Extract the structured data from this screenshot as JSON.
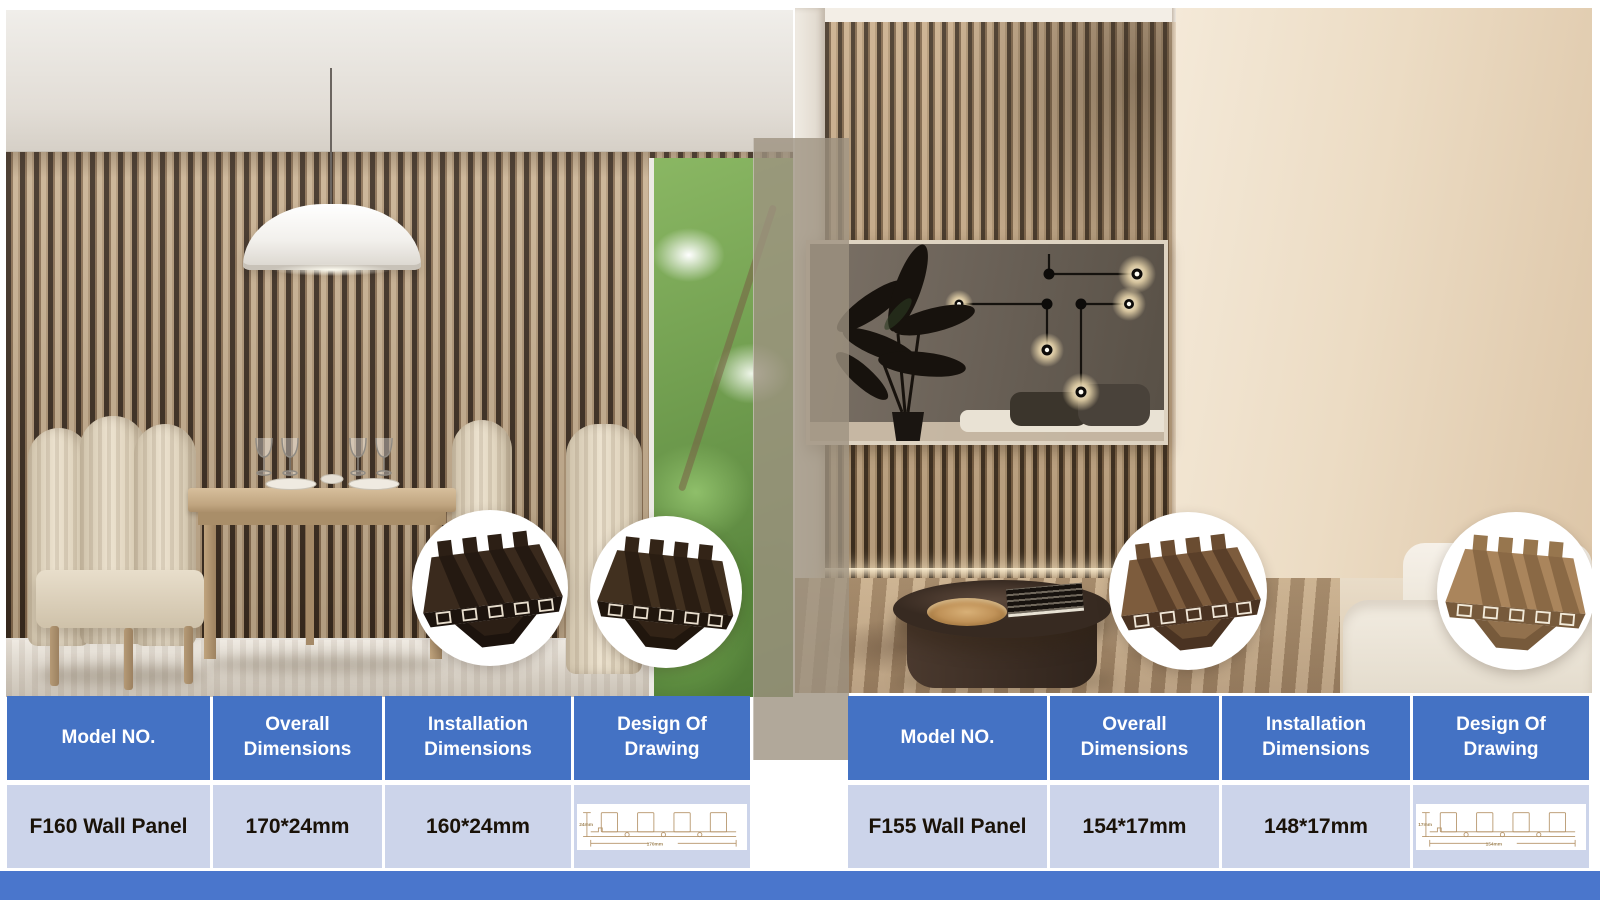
{
  "tables": {
    "headers": [
      "Model NO.",
      "Overall Dimensions",
      "Installation Dimensions",
      "Design Of Drawing"
    ],
    "left": {
      "model": "F160 Wall Panel",
      "overall_dimensions": "170*24mm",
      "installation_dimensions": "160*24mm",
      "drawing_height_label": "24mm",
      "drawing_width_label": "170mm"
    },
    "right": {
      "model": "F155 Wall Panel",
      "overall_dimensions": "154*17mm",
      "installation_dimensions": "148*17mm",
      "drawing_height_label": "17mm",
      "drawing_width_label": "154mm"
    }
  },
  "colors": {
    "header_blue": "#4472c4",
    "row_light_blue": "#ccd4ea",
    "bottom_bar_blue": "#4a76cc",
    "slat_wood": "#c8ab87",
    "slat_gap": "#40301f",
    "overlay_strip": "rgba(158,146,129,0.8)"
  }
}
